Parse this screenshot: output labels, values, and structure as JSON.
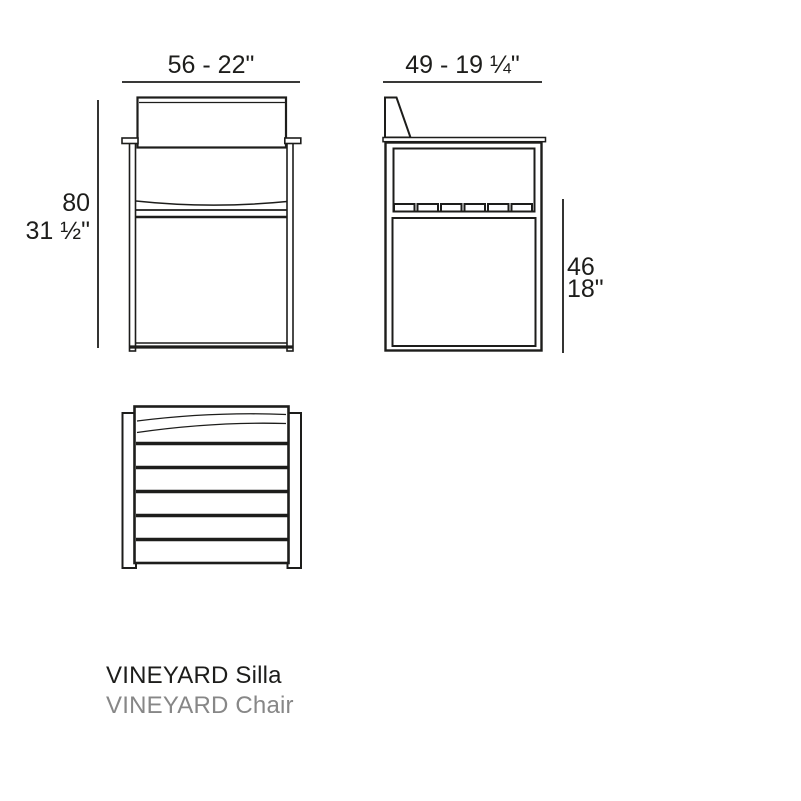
{
  "drawing": {
    "line_color": "#1d1d1b",
    "background_color": "#ffffff"
  },
  "dimensions": {
    "front_width": "56 - 22\"",
    "front_height_cm": "80",
    "front_height_in": "31 ½\"",
    "side_depth": "49 - 19 ¼\"",
    "side_seat_height_cm": "46",
    "side_seat_height_in": "18\""
  },
  "title": {
    "primary": "VINEYARD Silla",
    "secondary": "VINEYARD Chair",
    "primary_color": "#1d1d1b",
    "secondary_color": "#878787"
  }
}
